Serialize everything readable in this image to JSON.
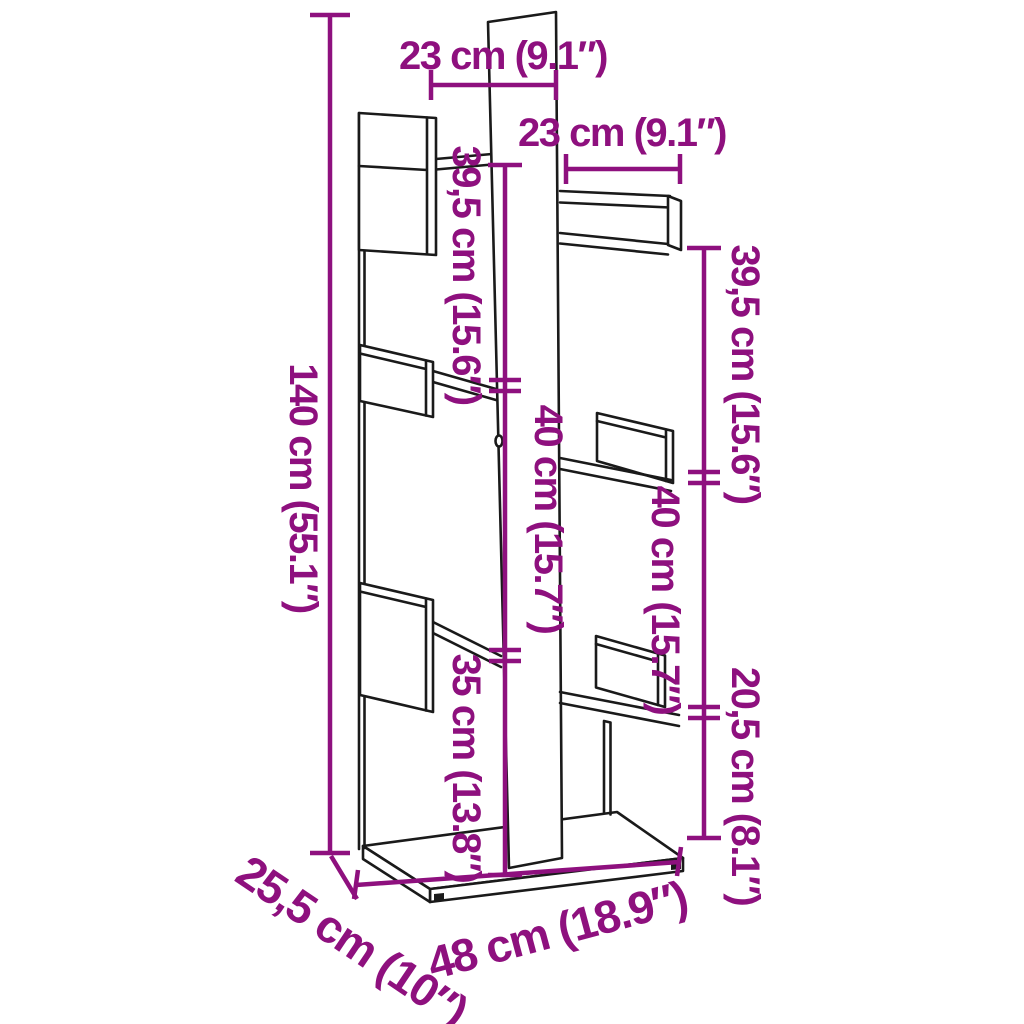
{
  "page": {
    "title": "Tree-shaped bookshelf dimension diagram"
  },
  "colors": {
    "dimension_accent": "#8E107E",
    "outline": "#1a1a1a",
    "background": "#ffffff",
    "panel_fill": "#ffffff",
    "foot_fill": "#1a1a1a"
  },
  "diagram": {
    "type": "product-dimension-diagram",
    "product": "tree-shaped bookshelf",
    "labels": {
      "width_top_left": "23 cm (9.1″)",
      "width_top_right": "23 cm (9.1″)",
      "total_height": "140 cm (55.1″)",
      "upper_left_height": "39,5 cm (15.6″)",
      "upper_right_height": "39,5 cm (15.6″)",
      "middle_left_height": "40 cm (15.7″)",
      "middle_right_height": "40 cm (15.7″)",
      "lower_left_height": "35 cm (13.8″)",
      "lower_right_height": "20,5 cm (8.1″)",
      "total_width": "48 cm (18.9″)",
      "depth": "25,5 cm (10″)"
    }
  }
}
